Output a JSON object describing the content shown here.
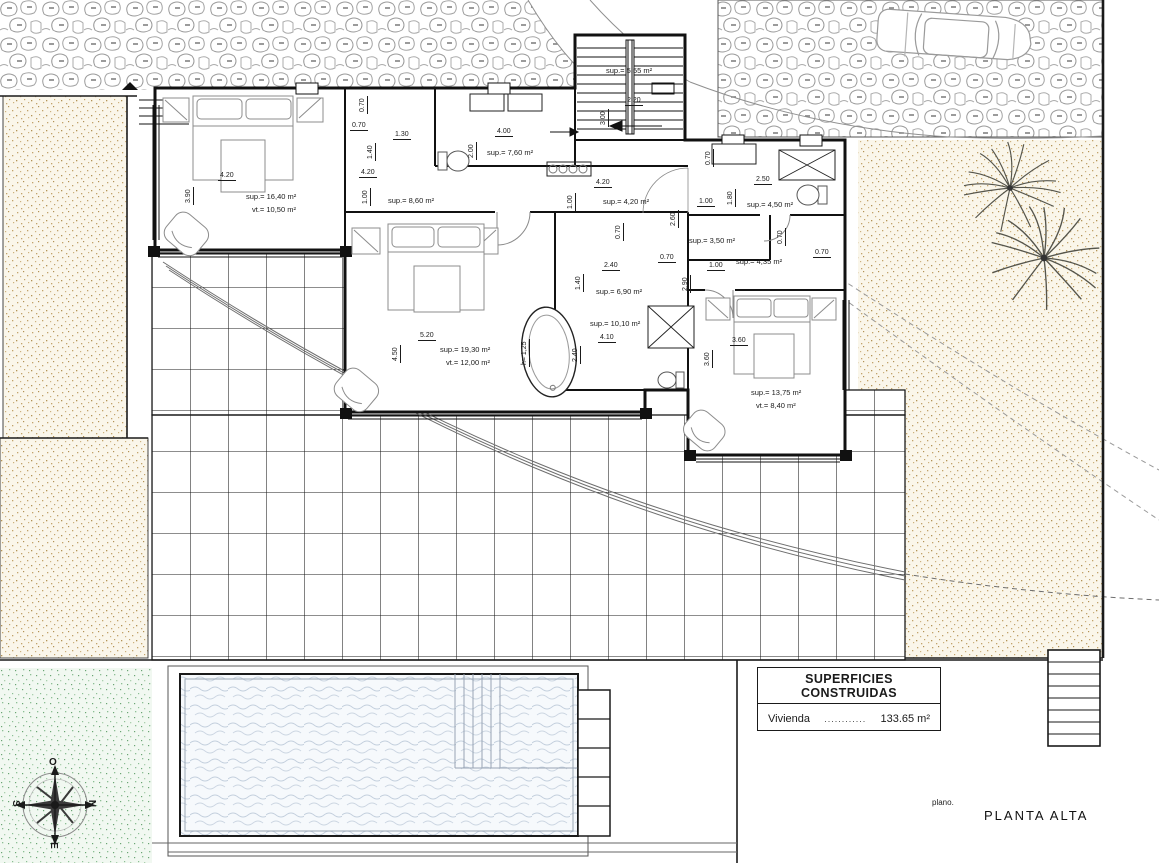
{
  "drawing": {
    "plan": {
      "prefix": "plano.",
      "name": "PLANTA ALTA"
    },
    "title_block": {
      "header": "SUPERFICIES CONSTRUIDAS",
      "row_label": "Vivienda",
      "dots": "............",
      "value": "133.65 m²"
    },
    "compass": {
      "n": "N",
      "s": "S",
      "e": "E",
      "o": "O"
    },
    "rooms": {
      "bedroom1": {
        "sup": "sup.= 16,40 m²",
        "vt": "vt.= 10,50 m²"
      },
      "hall": {
        "sup": "sup.= 8,60 m²"
      },
      "bath_top": {
        "sup": "sup.= 7,60 m²"
      },
      "stairs": {
        "sup": "sup.= 5,55 m²"
      },
      "landing": {
        "sup": "sup.= 4,20 m²"
      },
      "bath_right": {
        "sup": "sup.= 4,50 m²"
      },
      "closet": {
        "sup": "sup.= 3,50 m²"
      },
      "hall2": {
        "sup": "sup.= 4,35 m²"
      },
      "dressing": {
        "sup": "sup.= 6,90 m²"
      },
      "bath_mid": {
        "sup": "sup.= 10,10 m²"
      },
      "master": {
        "sup": "sup.= 19,30 m²",
        "vt": "vt.= 12,00 m²"
      },
      "bedroom3": {
        "sup": "sup.= 13,75 m²",
        "vt": "vt.= 8,40 m²"
      }
    },
    "dims": {
      "v070": "0.70",
      "v100": "1.00",
      "v125": "h= 1,25",
      "v130": "1.30",
      "v140": "1.40",
      "v180": "1.80",
      "v200": "2.00",
      "v220": "2.20",
      "v240": "2.40",
      "v250": "2.50",
      "v260": "2.60",
      "v290": "2.90",
      "v300": "3.00",
      "v360": "3.60",
      "v390": "3.90",
      "v400": "4.00",
      "v410": "4.10",
      "v420": "4.20",
      "v450": "4.50",
      "v520": "5.20"
    },
    "colors": {
      "line": "#1a1a1a",
      "stone_hatch": "#9a9a9a",
      "sand_dots": "#c2a36b",
      "green_dots": "#8cbf94",
      "water_waves": "#c3cfdd"
    }
  }
}
